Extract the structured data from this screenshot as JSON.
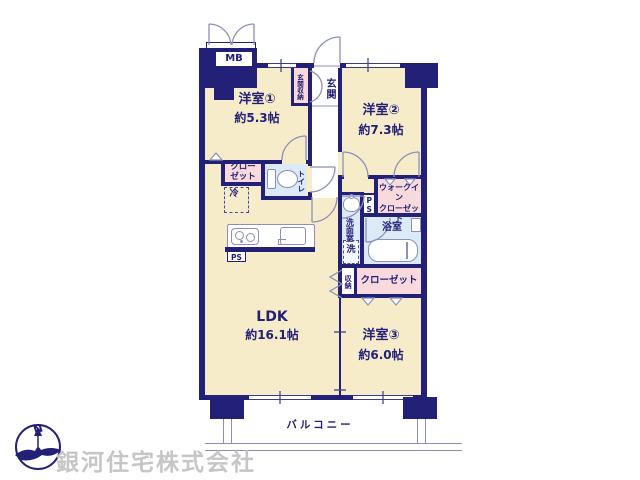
{
  "plan": {
    "rooms": {
      "r1": {
        "name": "洋室①",
        "size": "約5.3帖"
      },
      "r2": {
        "name": "洋室②",
        "size": "約7.3帖"
      },
      "r3": {
        "name": "洋室③",
        "size": "約6.0帖"
      },
      "ldk": {
        "name": "LDK",
        "size": "約16.1帖"
      }
    },
    "labels": {
      "mb": "MB",
      "genkan": "玄関",
      "genkan_storage": "玄関収納",
      "closet_r1": "クロー\nゼット",
      "fridge": "冷",
      "toilet": "トイレ",
      "walkin_closet": "ウォークイン\nクローゼット",
      "ps_wet": "PS",
      "ps_kitchen": "PS",
      "washroom": "洗面室",
      "washer": "洗",
      "bathroom": "浴室",
      "storage": "収納",
      "closet_r3": "クローゼット",
      "balcony": "バルコニー"
    },
    "colors": {
      "wall": "#232078",
      "floor": "#f7ecca",
      "closet": "#f8d9dc",
      "wet_area": "#dce9f6",
      "thin_line": "#8a90bb",
      "watermark": "#c6c6c6"
    }
  },
  "compass": {
    "north": "N"
  },
  "footer": {
    "company": "銀河住宅株式会社"
  }
}
